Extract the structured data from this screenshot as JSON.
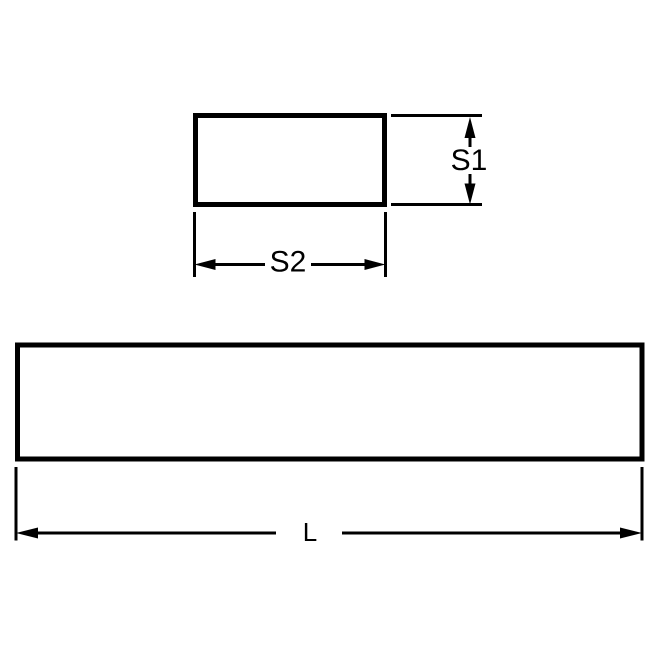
{
  "diagram": {
    "kind": "engineering-dimension-drawing",
    "background_color": "#ffffff",
    "line_color": "#000000",
    "cross_section_view": {
      "height_label": "S1",
      "width_label": "S2"
    },
    "side_view": {
      "length_label": "L"
    }
  }
}
